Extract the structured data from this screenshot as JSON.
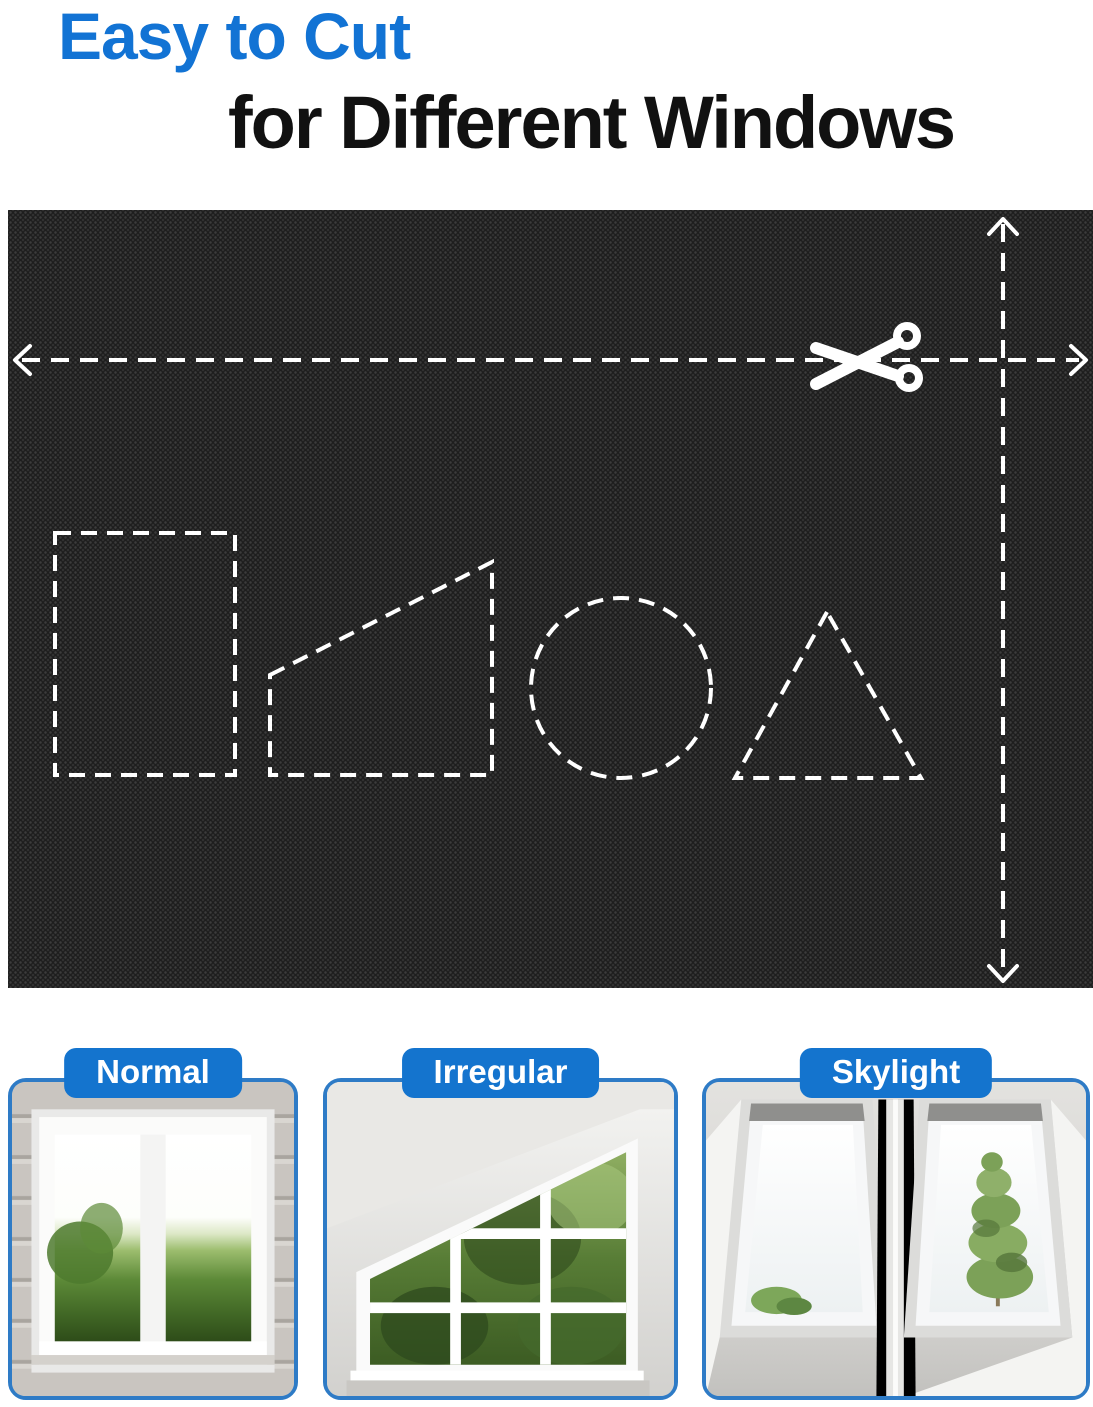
{
  "header": {
    "title_accent": "Easy to Cut",
    "title_rest": "for Different Windows"
  },
  "fabric_panel": {
    "cut_guides": [
      "horizontal-cut-line",
      "vertical-cut-line"
    ],
    "cut_shapes": [
      "rectangle",
      "trapezoid",
      "circle",
      "triangle"
    ],
    "icon": "scissors-icon"
  },
  "cards": [
    {
      "label": "Normal"
    },
    {
      "label": "Irregular"
    },
    {
      "label": "Skylight"
    }
  ],
  "colors": {
    "accent_blue": "#1273d4",
    "badge_blue": "#1474ce",
    "card_border_blue": "#2e7bc6",
    "fabric_black": "#1e1e1e",
    "cut_line_white": "#ffffff"
  }
}
